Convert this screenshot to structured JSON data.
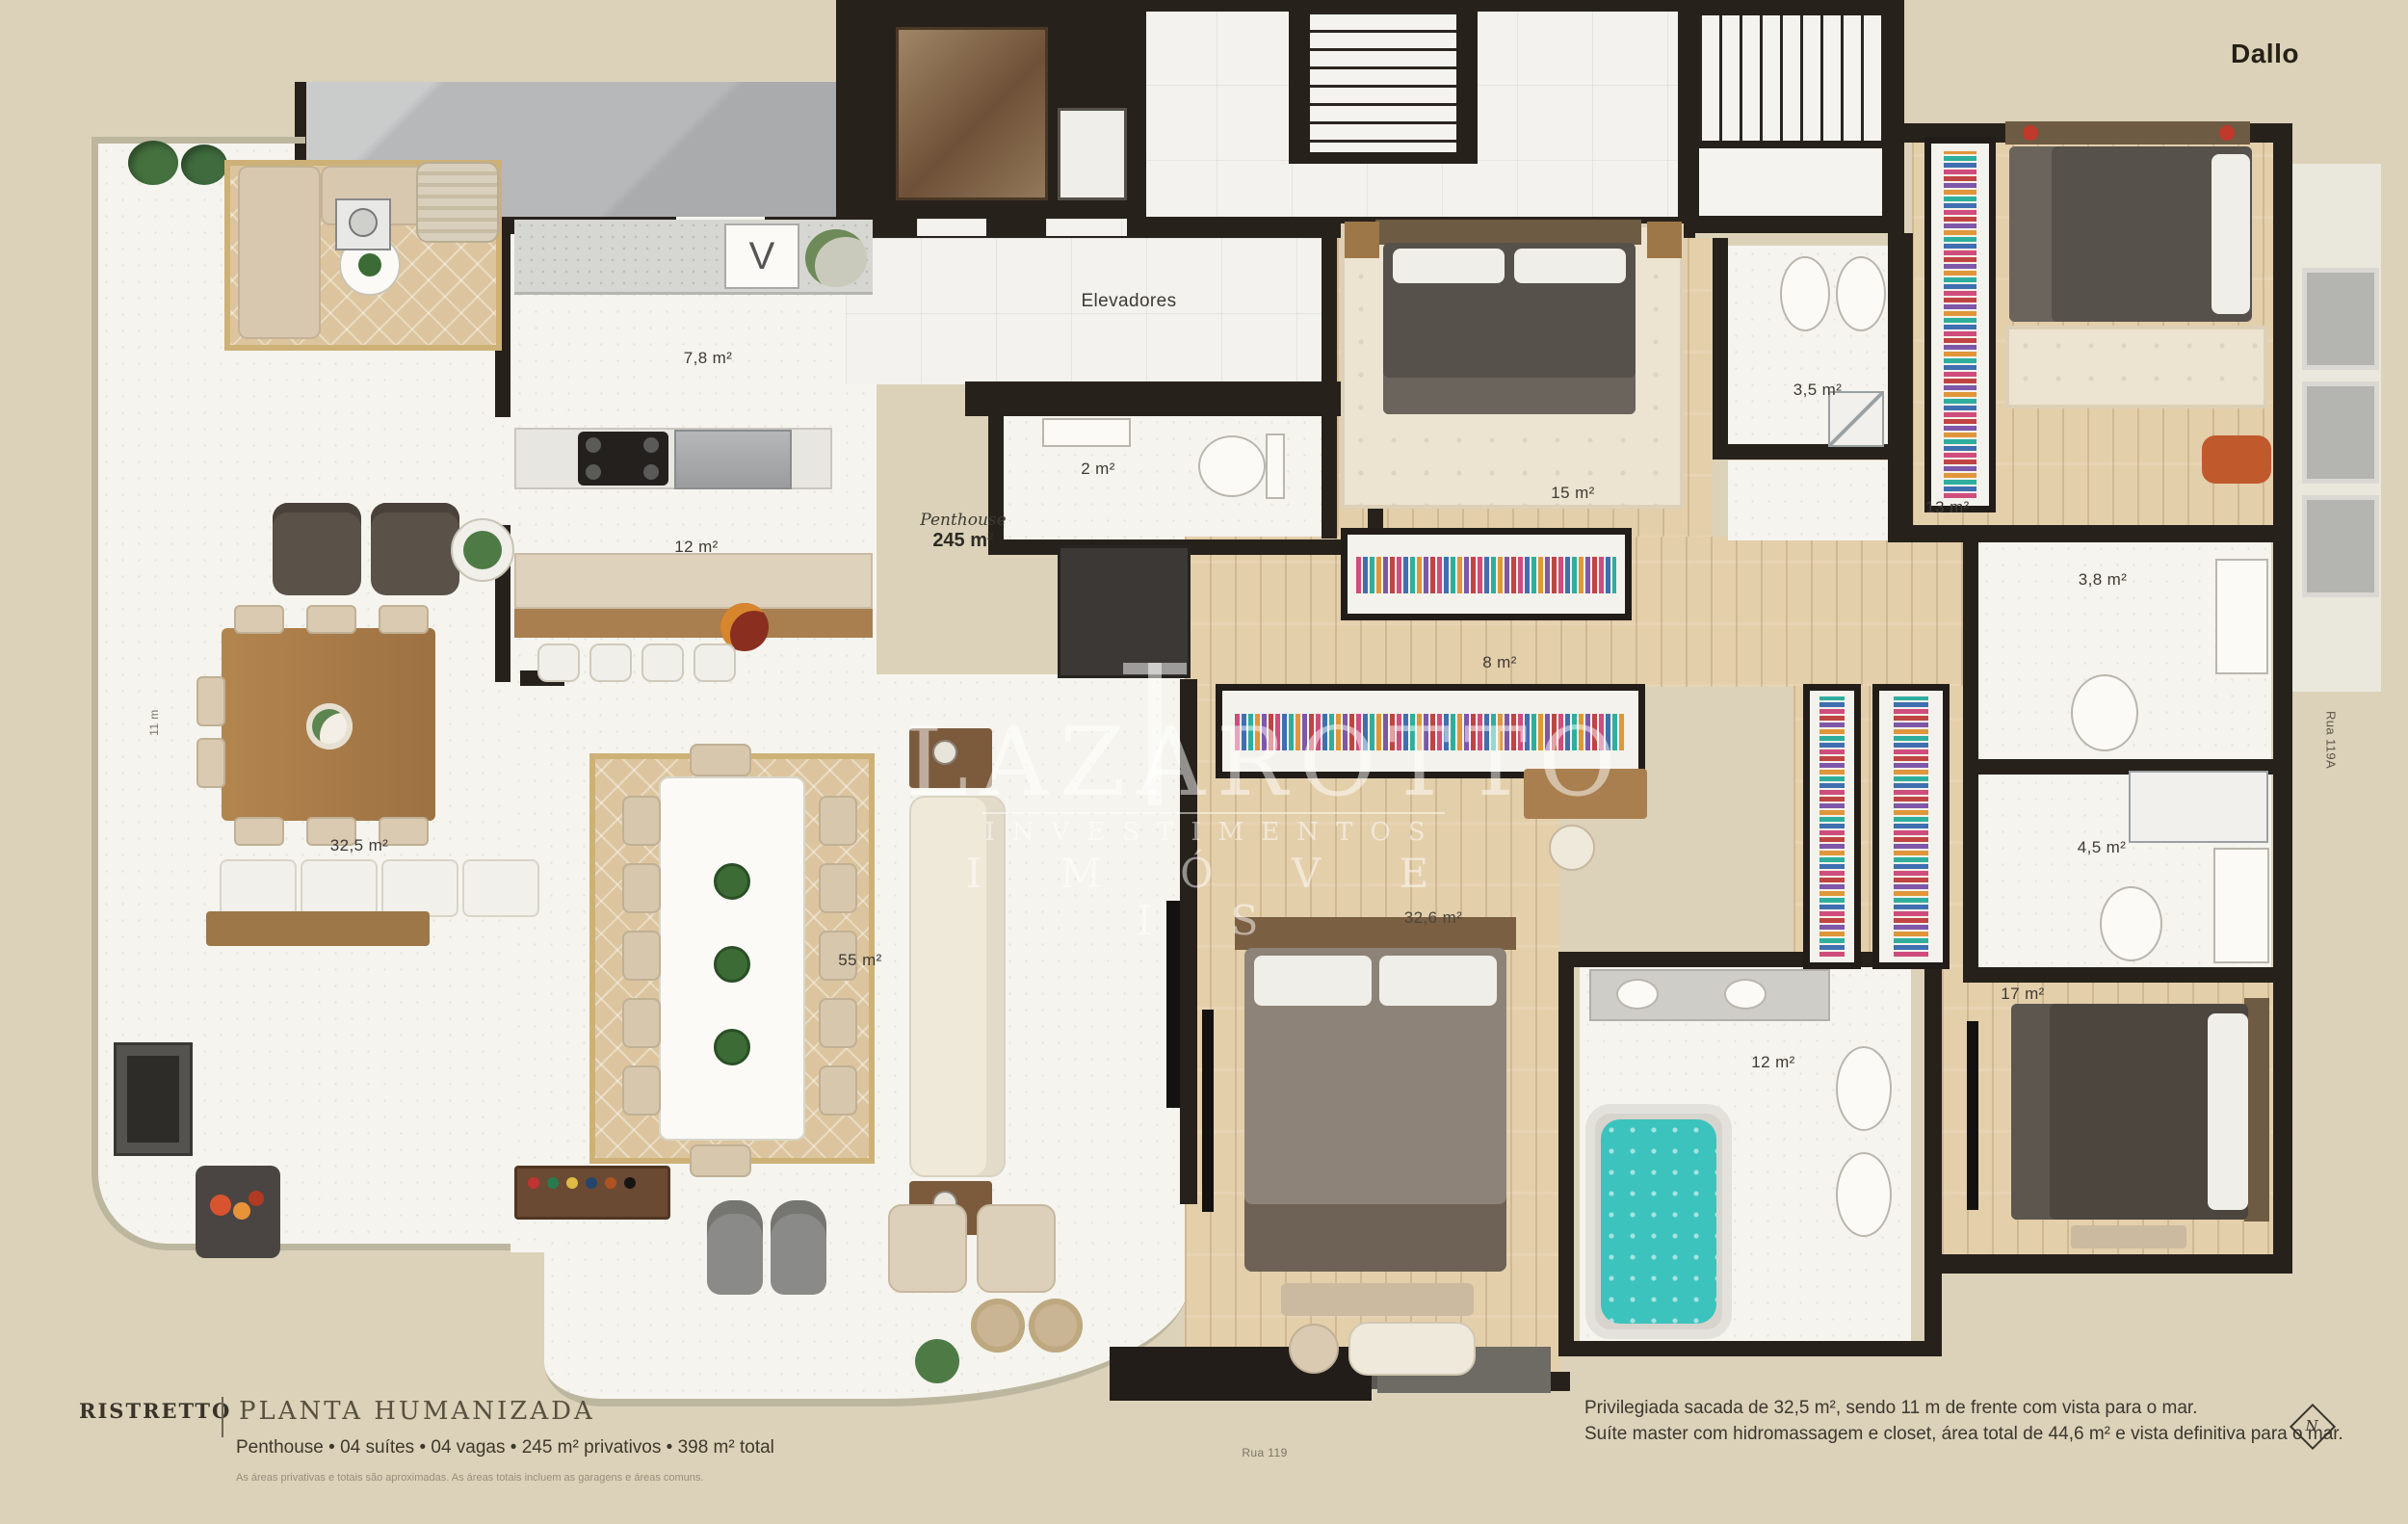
{
  "brand": {
    "logo": "Dallo"
  },
  "watermark": {
    "line1": "LAZAROTTO",
    "line2": "INVESTIMENTOS",
    "line3": "I M Ó V E I S"
  },
  "labels": {
    "elevators": "Elevadores"
  },
  "penthouse": {
    "name": "Penthouse",
    "area": "245 m²"
  },
  "rooms": [
    {
      "name": "service-area",
      "label": "7,8 m²"
    },
    {
      "name": "kitchen",
      "label": "12 m²"
    },
    {
      "name": "lavabo",
      "label": "2 m²"
    },
    {
      "name": "suite-2",
      "label": "15 m²"
    },
    {
      "name": "bath-suite-2",
      "label": "3,5 m²"
    },
    {
      "name": "suite-3",
      "label": "13 m²"
    },
    {
      "name": "bath-suite-3",
      "label": "3,8 m²"
    },
    {
      "name": "hall",
      "label": "8 m²"
    },
    {
      "name": "terrace",
      "label": "32,5 m²"
    },
    {
      "name": "living",
      "label": "55 m²"
    },
    {
      "name": "master-suite",
      "label": "32,6 m²"
    },
    {
      "name": "bath-4-5",
      "label": "4,5 m²"
    },
    {
      "name": "master-bath",
      "label": "12 m²"
    },
    {
      "name": "suite-4",
      "label": "17 m²"
    }
  ],
  "streets": {
    "bottom": "Rua 119",
    "right": "Rua 119A",
    "left_dimension": "11 m"
  },
  "footer": {
    "brand": "Ristretto",
    "title": "PLANTA HUMANIZADA",
    "subtitle": "Penthouse • 04 suítes • 04 vagas • 245 m² privativos • 398 m² total",
    "disclaimer": "As áreas privativas e totais são aproximadas. As áreas totais incluem as garagens e áreas comuns."
  },
  "description": {
    "line1": "Privilegiada sacada de 32,5 m², sendo 11 m de frente com vista para o mar.",
    "line2": "Suíte master com hidromassagem e closet, área total de 44,6 m² e vista definitiva para o mar."
  },
  "compass": {
    "north": "N"
  },
  "colors": {
    "background": "#dbd2b9",
    "walls": "#27211c",
    "wood_floor": "#e4cfab",
    "hydro_water": "#3cc3bd",
    "rug": "#dcc59e",
    "accent_red": "#c0392b"
  }
}
